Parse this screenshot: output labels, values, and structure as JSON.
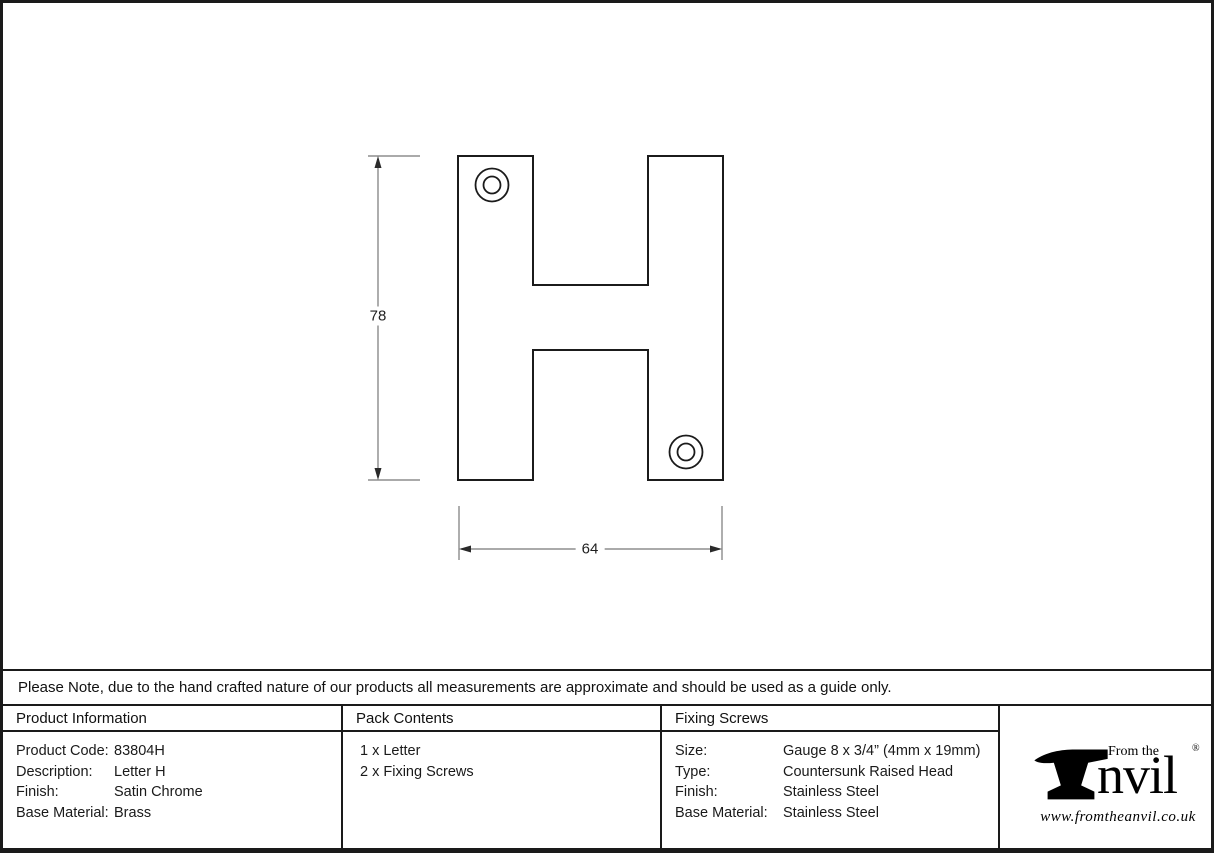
{
  "drawing": {
    "height_dimension": "78",
    "width_dimension": "64",
    "subject": "Letter H technical outline with two screw holes"
  },
  "note": "Please Note, due to the hand crafted nature of our products all measurements are approximate and should be used as a guide only.",
  "product_information": {
    "header": "Product Information",
    "rows": [
      {
        "label": "Product Code:",
        "value": "83804H"
      },
      {
        "label": "Description:",
        "value": "Letter H"
      },
      {
        "label": "Finish:",
        "value": "Satin Chrome"
      },
      {
        "label": "Base Material:",
        "value": "Brass"
      }
    ]
  },
  "pack_contents": {
    "header": "Pack Contents",
    "items": [
      "1 x Letter",
      "2 x Fixing Screws"
    ]
  },
  "fixing_screws": {
    "header": "Fixing Screws",
    "rows": [
      {
        "label": "Size:",
        "value": "Gauge 8 x 3/4” (4mm x 19mm)"
      },
      {
        "label": "Type:",
        "value": "Countersunk Raised Head"
      },
      {
        "label": "Finish:",
        "value": "Stainless Steel"
      },
      {
        "label": "Base Material:",
        "value": "Stainless Steel"
      }
    ]
  },
  "logo": {
    "from_the": "From the",
    "brand": "nvil",
    "registered": "®",
    "url": "www.fromtheanvil.co.uk"
  },
  "colors": {
    "ink": "#1a1a1a",
    "dimension_line": "#777777",
    "background": "#ffffff"
  }
}
